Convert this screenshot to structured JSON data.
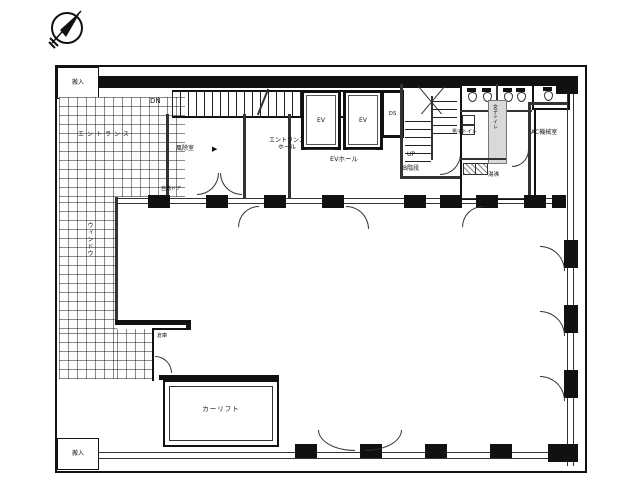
{
  "floor_plan": {
    "compass": "north-arrow-icon",
    "labels": {
      "delivery_top": "搬入",
      "delivery_bottom": "搬入",
      "entrance": "エントランス",
      "window_line": "ウィンドウ",
      "stair_dn": "DN",
      "stair_up": "UP",
      "vestibule": "風除室",
      "vestibule_arrow": "▶",
      "auto_door": "自動ドア",
      "entrance_hall_line1": "エントランス",
      "entrance_hall_line2": "ホール",
      "elevator1": "EV",
      "elevator2": "EV",
      "duct_space": "DS",
      "ev_hall": "EVホール",
      "b_stair_up": "UP",
      "b_stair": "B階段",
      "mens_wc": "男子トイレ",
      "womens_wc": "女子トイレ",
      "hot_water": "湯沸",
      "ac_machine_room": "AC機械室",
      "storage": "倉庫",
      "car_lift": "カーリフト"
    },
    "colors": {
      "wall": "#111111",
      "line": "#333333",
      "shaded_area": "#d9d9d9",
      "background": "#ffffff"
    }
  }
}
